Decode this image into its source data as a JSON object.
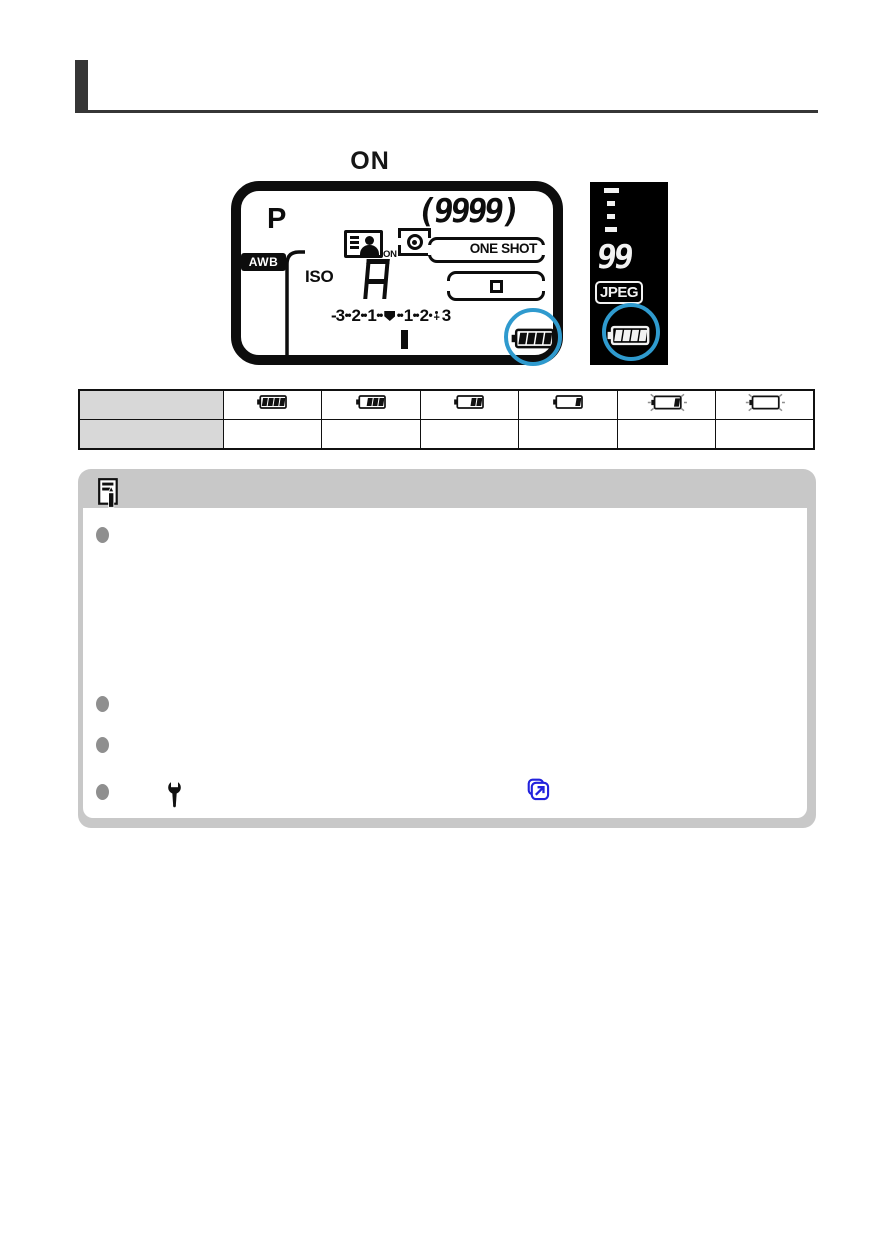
{
  "page": {
    "background": "#ffffff",
    "accent_color": "#363636"
  },
  "power_switch_label": "ON",
  "lcd_panel": {
    "shooting_mode": "P",
    "white_balance_badge": "AWB",
    "iso_label": "ISO",
    "iso_value": "A",
    "shots_remaining": "(9999)",
    "af_operation": "ONE SHOT",
    "display_on_sub_label": "ON",
    "exposure_scale_tokens": [
      {
        "t": "num",
        "v": "-3"
      },
      {
        "t": "dots"
      },
      {
        "t": "num",
        "v": "2"
      },
      {
        "t": "dots"
      },
      {
        "t": "num",
        "v": "1"
      },
      {
        "t": "dots"
      },
      {
        "t": "pointer"
      },
      {
        "t": "dots"
      },
      {
        "t": "num",
        "v": "1"
      },
      {
        "t": "dots"
      },
      {
        "t": "num",
        "v": "2"
      },
      {
        "t": "dot"
      },
      {
        "t": "plus"
      },
      {
        "t": "num",
        "v": "3"
      }
    ],
    "battery": {
      "segments": 4,
      "blinking": false
    },
    "highlight_circle_color": "#2f9ace"
  },
  "viewfinder_panel": {
    "background": "#000000",
    "max_burst": "99",
    "image_quality": "JPEG",
    "battery": {
      "segments": 4,
      "blinking": false
    },
    "highlight_circle_color": "#2f9ace"
  },
  "battery_table": {
    "header_column_bg": "#d8d8d8",
    "header_cells": [
      "",
      ""
    ],
    "level_columns": [
      {
        "name": "battery-level-4",
        "segments": 4,
        "blinking": false
      },
      {
        "name": "battery-level-3",
        "segments": 3,
        "blinking": false
      },
      {
        "name": "battery-level-2",
        "segments": 2,
        "blinking": false
      },
      {
        "name": "battery-level-1",
        "segments": 1,
        "blinking": false
      },
      {
        "name": "battery-level-1-blinking",
        "segments": 1,
        "blinking": true
      },
      {
        "name": "battery-level-0-blinking",
        "segments": 0,
        "blinking": true
      }
    ],
    "second_row_cells": [
      "",
      "",
      "",
      "",
      "",
      ""
    ]
  },
  "note_box": {
    "background": "#c8c8c8",
    "bullets": [
      "",
      "",
      "",
      ""
    ],
    "link_color": "#2222dd"
  }
}
